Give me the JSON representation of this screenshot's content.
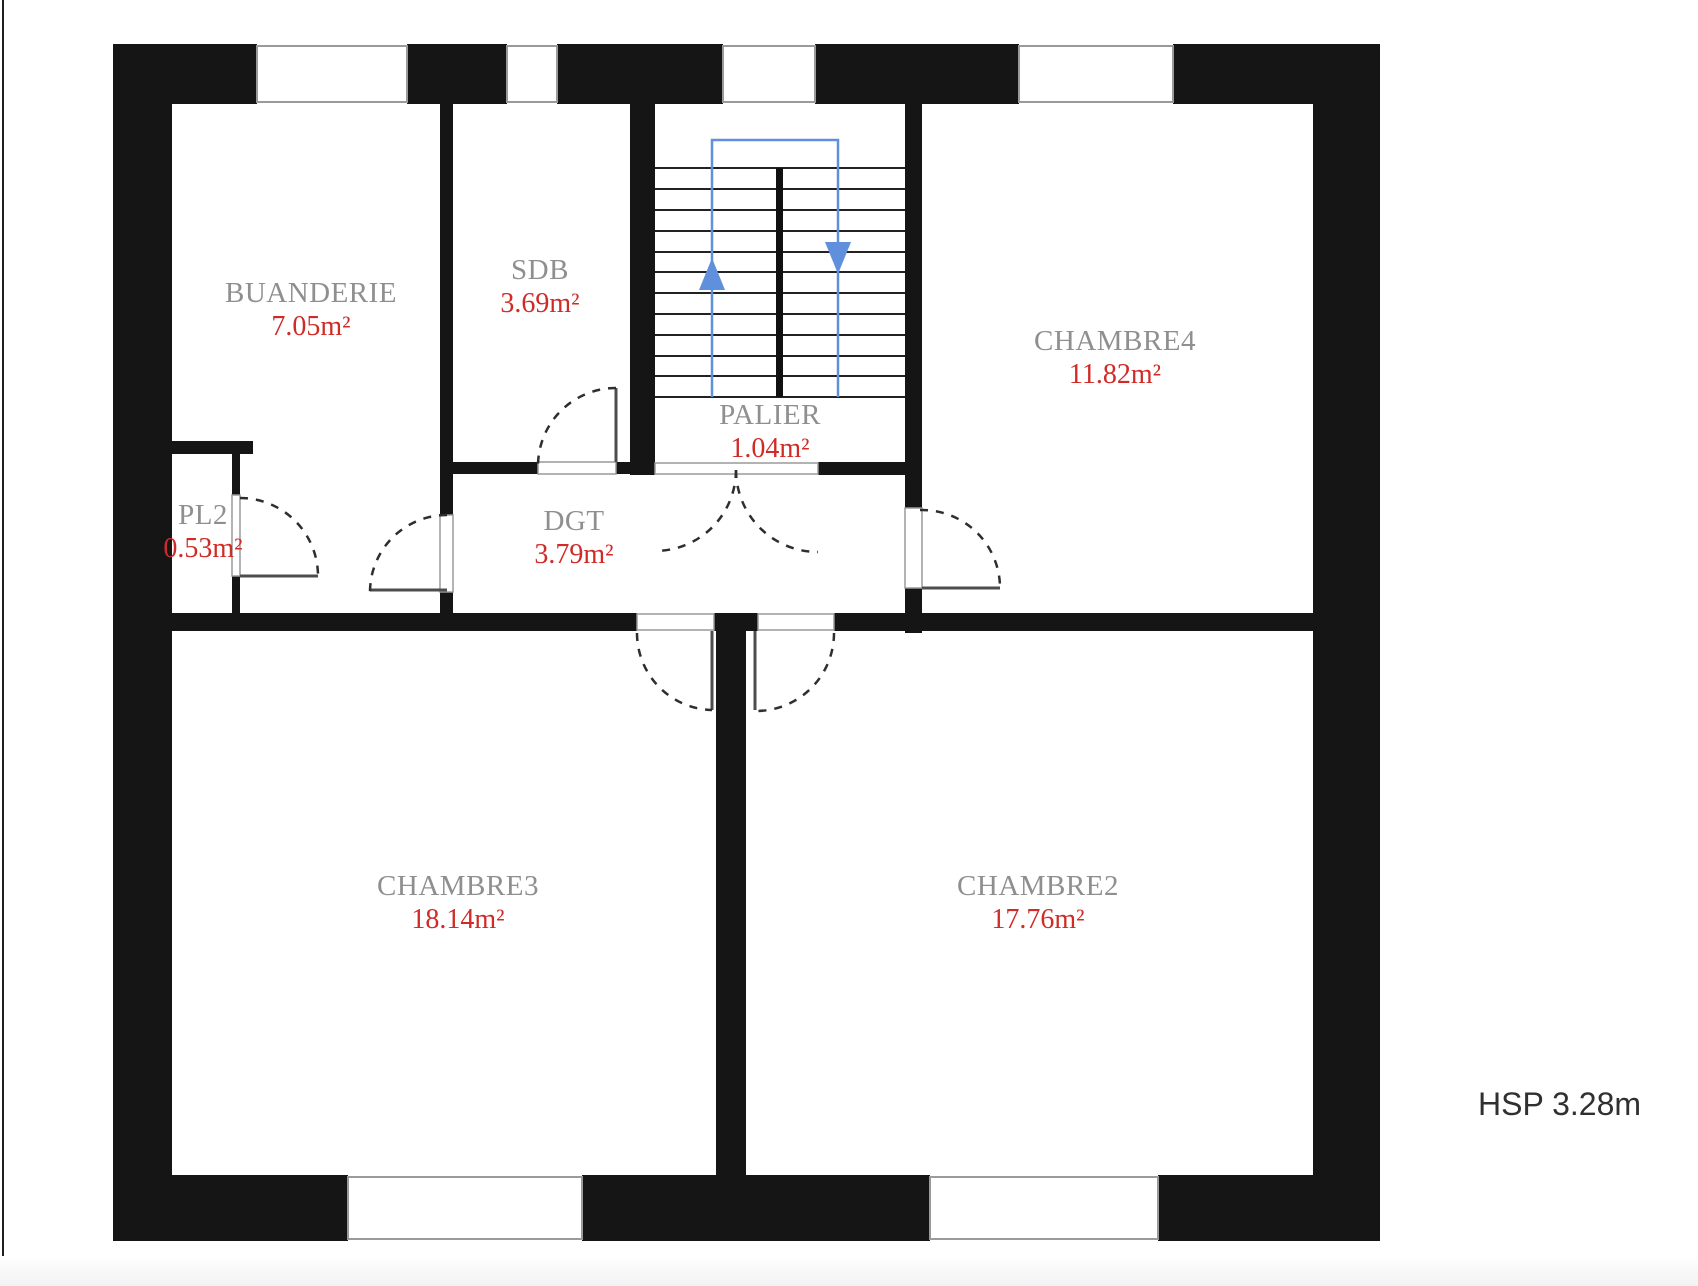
{
  "rooms": [
    {
      "id": "buanderie",
      "name": "BUANDERIE",
      "area": "7.05m²"
    },
    {
      "id": "sdb",
      "name": "SDB",
      "area": "3.69m²"
    },
    {
      "id": "palier",
      "name": "PALIER",
      "area": "1.04m²"
    },
    {
      "id": "chambre4",
      "name": "CHAMBRE4",
      "area": "11.82m²"
    },
    {
      "id": "pl2",
      "name": "PL2",
      "area": "0.53m²"
    },
    {
      "id": "dgt",
      "name": "DGT",
      "area": "3.79m²"
    },
    {
      "id": "chambre3",
      "name": "CHAMBRE3",
      "area": "18.14m²"
    },
    {
      "id": "chambre2",
      "name": "CHAMBRE2",
      "area": "17.76m²"
    }
  ],
  "annotations": {
    "hsp": "HSP 3.28m"
  },
  "stairs": {
    "up_arrow": "up",
    "down_arrow": "down",
    "flights": 2,
    "treads_per_flight": 11
  },
  "colors": {
    "wall": "#151515",
    "room_name": "#8f8f8f",
    "area_value": "#cf2b27",
    "stair_guide_blue": "#6090dc",
    "door_arc": "#2e2e2e",
    "window_frame": "#9a9a9a",
    "hsp_text": "#303030"
  }
}
